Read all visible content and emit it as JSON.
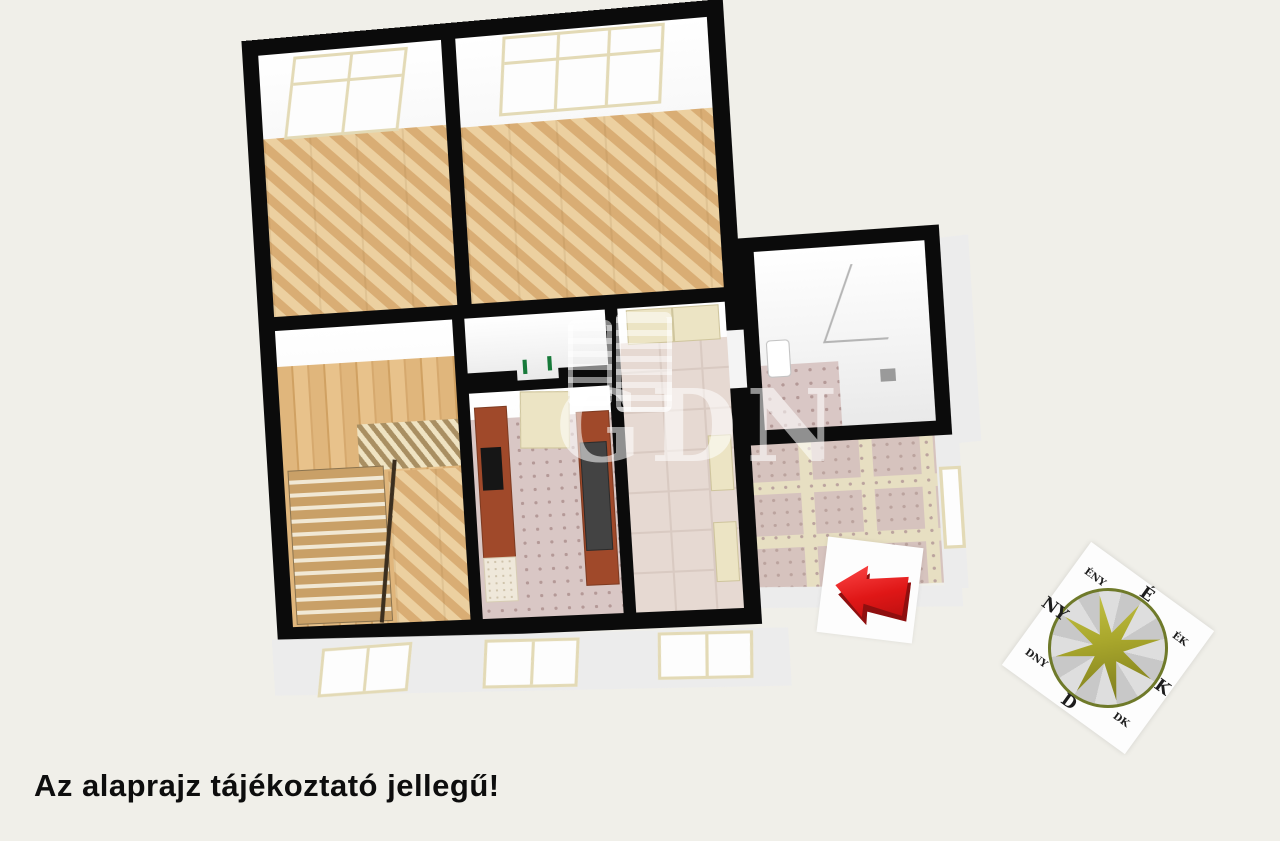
{
  "page": {
    "background_color": "#f0efe9"
  },
  "disclaimer": {
    "text": "Az alaprajz tájékoztató jellegű!"
  },
  "watermark": {
    "text": "GDN"
  },
  "direction_arrow": {
    "direction": "left",
    "color": "#e01717",
    "shadow_color": "#8f0f0f"
  },
  "compass": {
    "labels": [
      {
        "label": "É",
        "type": "cardinal"
      },
      {
        "label": "ÉK",
        "type": "intercardinal"
      },
      {
        "label": "K",
        "type": "cardinal"
      },
      {
        "label": "DK",
        "type": "intercardinal"
      },
      {
        "label": "D",
        "type": "cardinal"
      },
      {
        "label": "DNY",
        "type": "intercardinal"
      },
      {
        "label": "NY",
        "type": "cardinal"
      },
      {
        "label": "ÉNY",
        "type": "intercardinal"
      }
    ],
    "star_color": "#a9a72c",
    "ring_color": "#6f7a2a"
  },
  "floorplan": {
    "wall_color": "#0b0b0b",
    "floor_colors": {
      "parquet_herringbone": "#e0b985",
      "wood_plank": "#dfb67b",
      "kitchen_tile": "#d9c7c5",
      "hallway_tile": "#e6d9d2",
      "balcony_tile": "#d6c3be"
    },
    "accent_colors": {
      "window_frame": "#e3dab6",
      "kitchen_counter": "#a0492a"
    }
  }
}
